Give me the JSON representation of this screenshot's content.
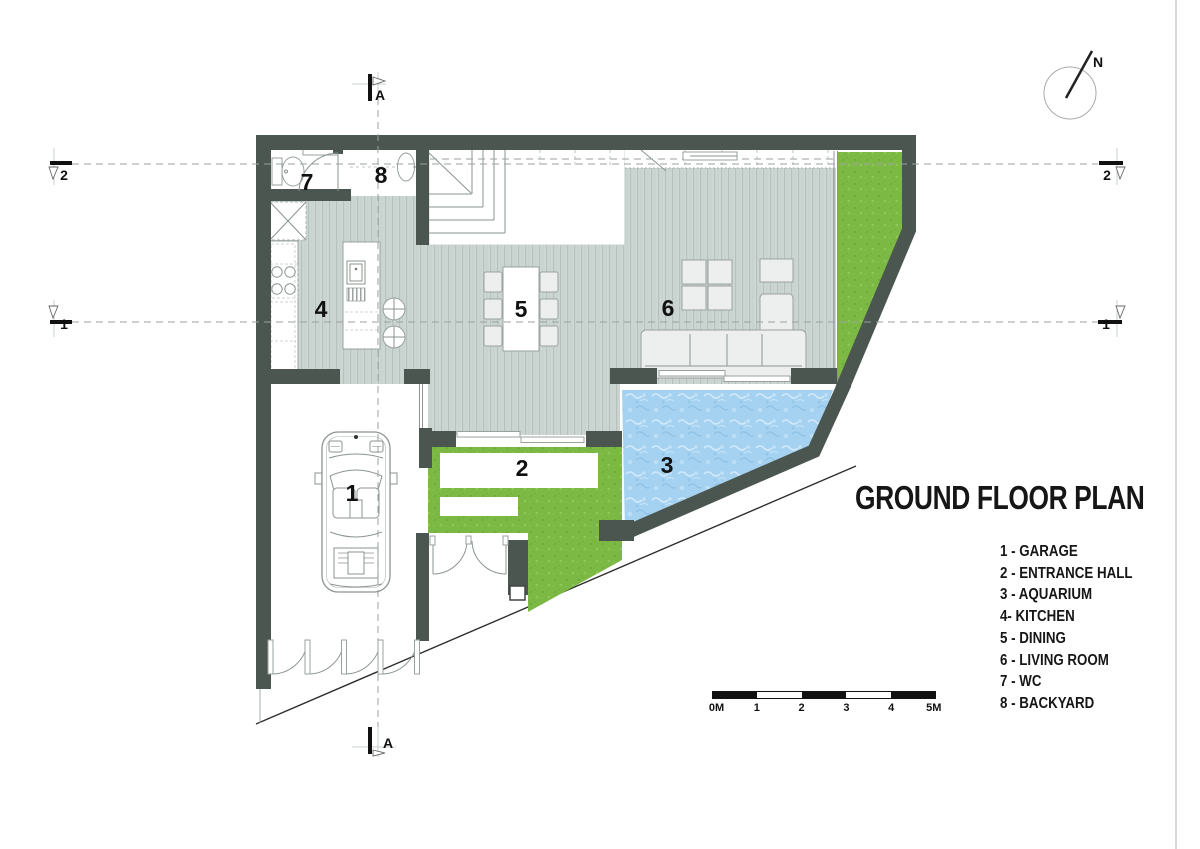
{
  "title": "GROUND FLOOR PLAN",
  "legend": {
    "items": [
      "1 - GARAGE",
      "2 - ENTRANCE HALL",
      "3 - AQUARIUM",
      "4- KITCHEN",
      "5 - DINING",
      "6 - LIVING ROOM",
      "7 - WC",
      "8 - BACKYARD"
    ]
  },
  "plan": {
    "labels": {
      "garage": "1",
      "entrance_hall": "2",
      "aquarium": "3",
      "kitchen": "4",
      "dining": "5",
      "living_room": "6",
      "wc": "7",
      "backyard": "8"
    }
  },
  "sections": {
    "a": "A",
    "level_1": "1",
    "level_2": "2"
  },
  "compass": {
    "label": "N"
  },
  "scale_bar": {
    "labels": [
      "0M",
      "1",
      "2",
      "3",
      "4",
      "5M"
    ]
  },
  "colors": {
    "wall": "#4a564f",
    "floor": "#ccd6d2",
    "grass": "#7cb944",
    "water": "#a5d2f0",
    "ink": "#111111"
  }
}
